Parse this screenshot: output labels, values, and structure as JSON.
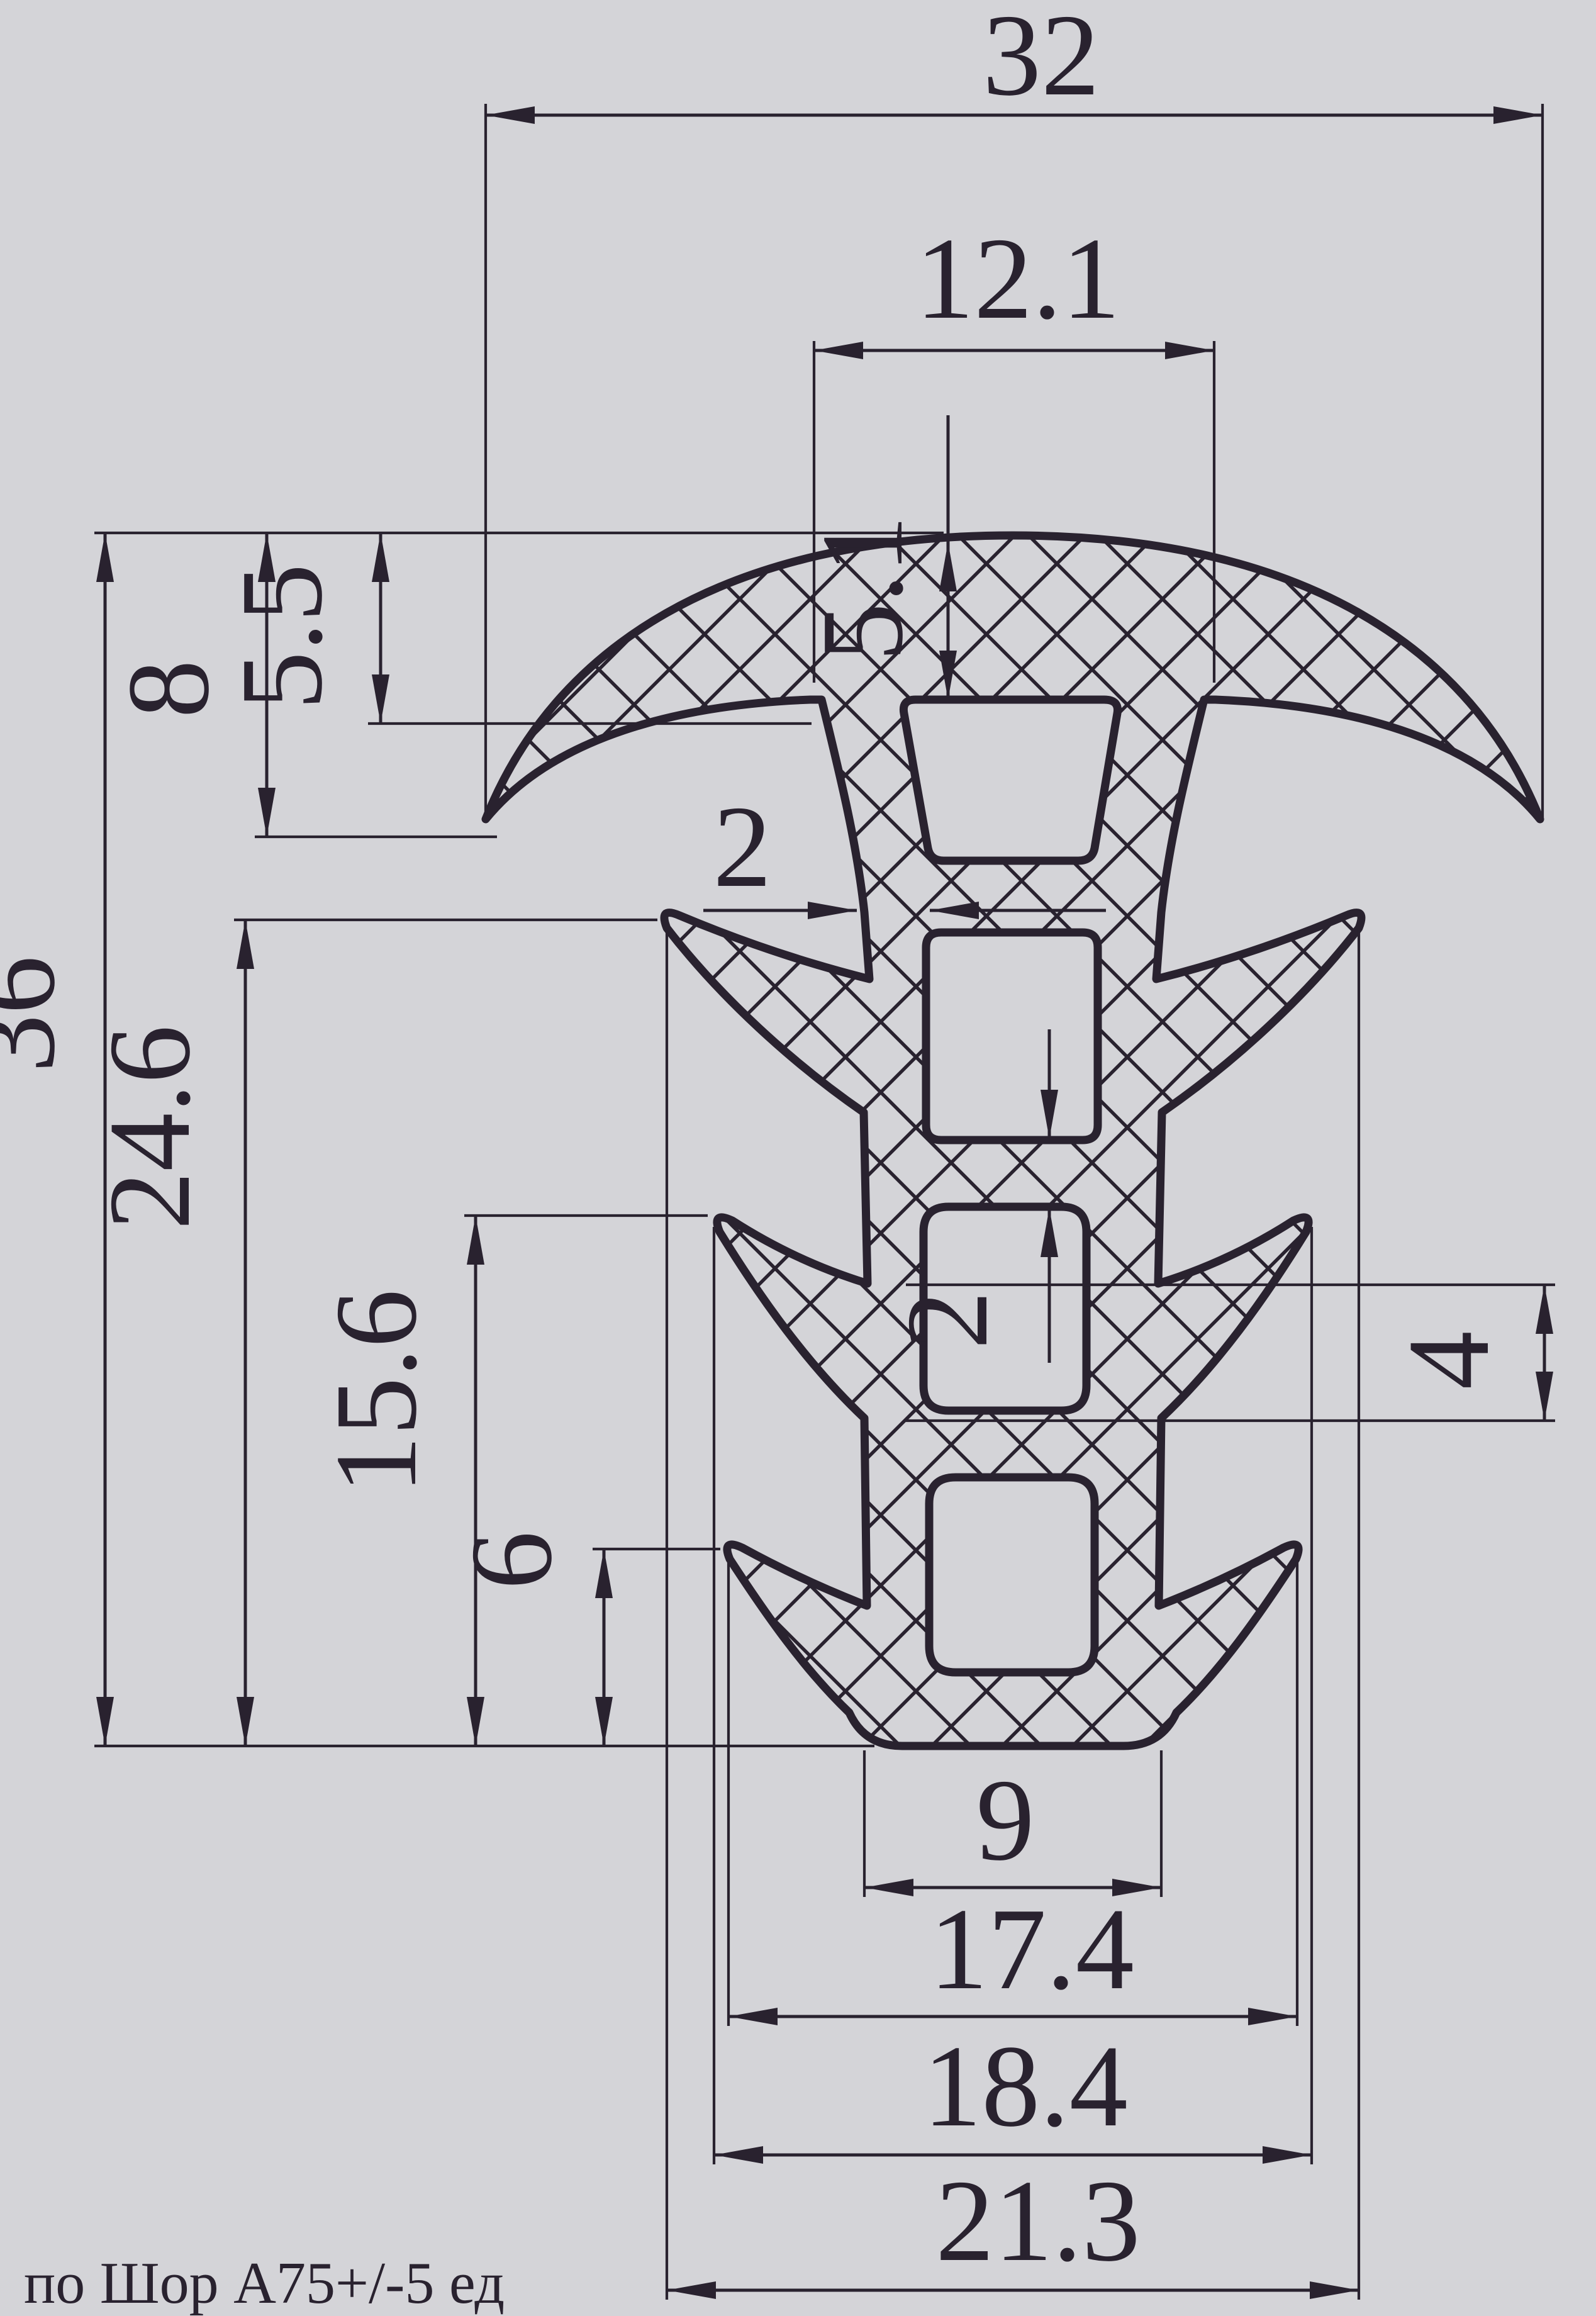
{
  "note": "по Шор А75+/-5 ед",
  "colors": {
    "background": "#d4d4d8",
    "ink": "#29222f"
  },
  "dims": {
    "overall_width": "32",
    "crown_junction_width": "12.1",
    "crown_hole_depth": "5.1",
    "crown_center_thickness": "5.5",
    "crown_height": "8",
    "stem_wall_thickness": "2",
    "overall_height": "36",
    "barb1_to_base": "24.6",
    "barb2_to_base": "15.6",
    "barb3_to_base": "6",
    "web_between_holes": "2",
    "barb_notch_height": "4",
    "base_width": "9",
    "barb3_span": "17.4",
    "barb2_span": "18.4",
    "barb1_span": "21.3"
  }
}
